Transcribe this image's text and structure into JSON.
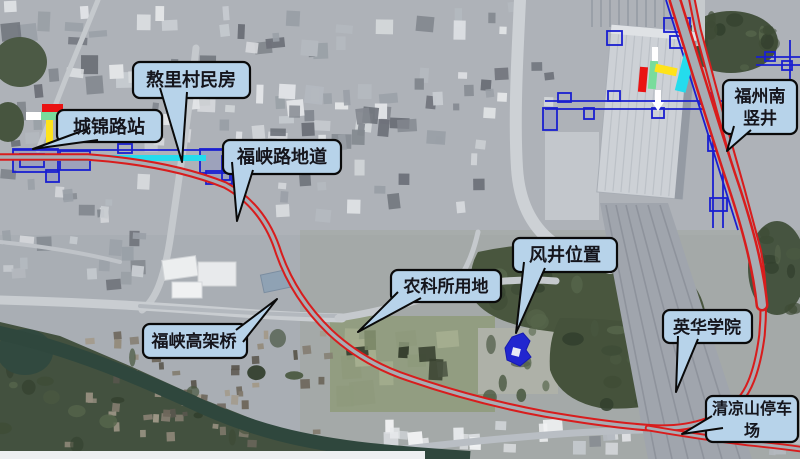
{
  "callouts": {
    "chengjin_station": {
      "label": "城锦路站"
    },
    "aoli_village": {
      "label": "熬里村民房"
    },
    "fuxia_underpass": {
      "label": "福峡路地道"
    },
    "fuxia_viaduct": {
      "label": "福峡高架桥"
    },
    "nongkesuo_land": {
      "label": "农科所用地"
    },
    "vent_shaft": {
      "label": "风井位置"
    },
    "yinghua_college": {
      "label": "英华学院"
    },
    "qingliangshan_parking": {
      "line1": "清凉山停车",
      "line2": "场"
    },
    "fuzhou_south_shaft": {
      "line1": "福州南",
      "line2": "竖井"
    }
  },
  "colors": {
    "alignment_red": "#d81d1d",
    "structure_blue": "#1a1fd0",
    "platform_cyan": "#24dced",
    "marker_red": "#ea1212",
    "marker_green": "#79dc9c",
    "marker_yellow": "#ffe31a",
    "callout_fill": "#b7d3ea",
    "callout_border": "#0a0a0a"
  }
}
